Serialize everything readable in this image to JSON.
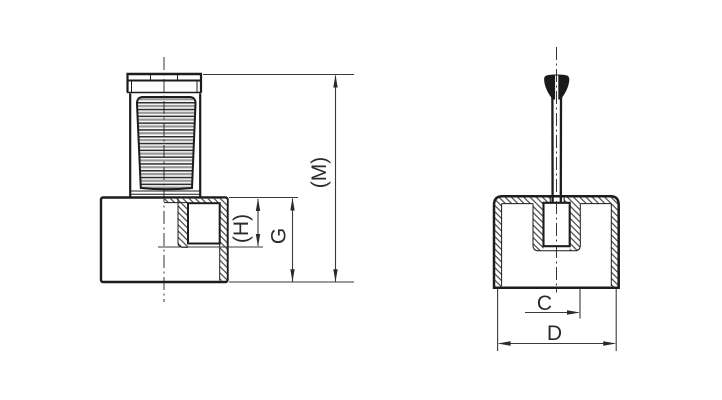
{
  "drawing": {
    "type": "technical-drawing-two-views",
    "views": {
      "front": {
        "name": "front-view-half-section-knurled-knob-on-base",
        "dimensions": [
          {
            "id": "M",
            "label": "(M)",
            "meaning": "overall-height"
          },
          {
            "id": "H",
            "label": "(H)",
            "meaning": "hole-depth"
          },
          {
            "id": "G",
            "label": "G",
            "meaning": "base-height"
          }
        ]
      },
      "side": {
        "name": "side-view-section-cap-with-pin",
        "dimensions": [
          {
            "id": "C",
            "label": "C",
            "meaning": "boss-offset-from-center"
          },
          {
            "id": "D",
            "label": "D",
            "meaning": "cap-outer-width"
          }
        ]
      }
    },
    "colors": {
      "background": "#ffffff",
      "outline": "#1c1c1c",
      "dim_line": "#3a3a3a",
      "hatch": "#2c2c2c",
      "knurl_dark": "#2e2e2e",
      "knurl_gray": "#969696"
    }
  }
}
